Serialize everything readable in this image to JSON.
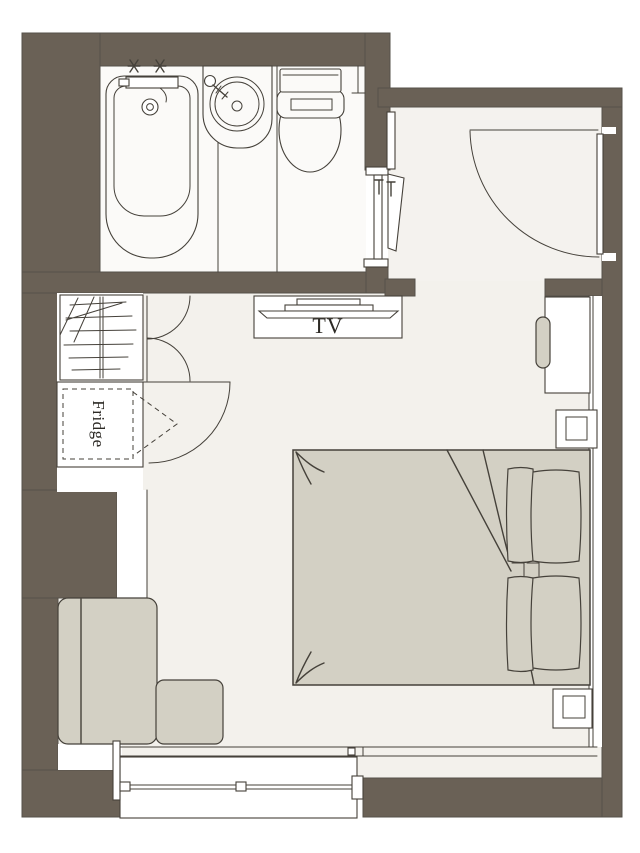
{
  "page": {
    "type": "hotel-room-floor-plan",
    "background": "#ffffff"
  },
  "labels": {
    "tv": "TV",
    "fridge": "Fridge"
  },
  "colors": {
    "background": "#ffffff",
    "wall": "#6a6156",
    "wall_edge": "#56514a",
    "line": "#45413a",
    "floor": "#f3f1ec",
    "corridor_floor": "#f4f2ee",
    "bathroom_floor": "#fbfaf8",
    "furniture": "#d3d0c4",
    "surface": "#ffffff",
    "text": "#2d2a25"
  },
  "rooms": [
    {
      "name": "bathroom"
    },
    {
      "name": "entry-hall"
    },
    {
      "name": "main-room"
    }
  ],
  "fixtures": [
    "bathtub",
    "bathtub-faucet",
    "washbasin",
    "toilet",
    "entrance-door",
    "bathroom-door",
    "closet-with-hangers",
    "bifold-doors",
    "refrigerator",
    "tv-console",
    "tv",
    "desk",
    "desk-chair",
    "side-table-upper",
    "double-bed",
    "pillows",
    "side-table-lower",
    "sofa",
    "ottoman",
    "sliding-window",
    "balcony-door"
  ]
}
